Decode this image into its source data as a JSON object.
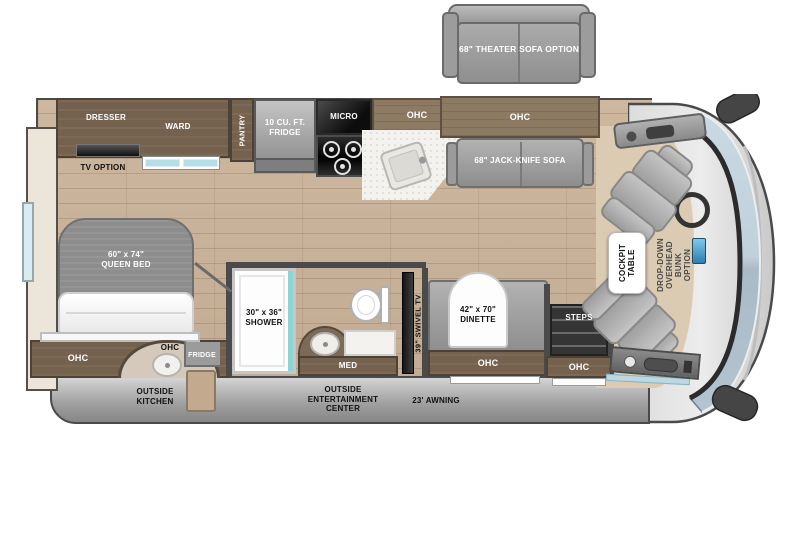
{
  "plan": {
    "type": "rv-floorplan",
    "labels": {
      "theater_sofa": "68\" THEATER SOFA OPTION",
      "dresser": "DRESSER",
      "ward": "WARD",
      "pantry": "PANTRY",
      "tv_option": "TV OPTION",
      "fridge": [
        "10 CU. FT.",
        "FRIDGE"
      ],
      "micro": "MICRO",
      "ohc": "OHC",
      "jack_knife_sofa": "68\" JACK-KNIFE SOFA",
      "queen_bed": [
        "60\" x 74\"",
        "QUEEN BED"
      ],
      "outside_fridge": "FRIDGE",
      "outside_kitchen": [
        "OUTSIDE",
        "KITCHEN"
      ],
      "shower": [
        "30\" x 36\"",
        "SHOWER"
      ],
      "med": "MED",
      "swivel_tv": "39\" SWIVEL TV",
      "dinette": [
        "42\" x 70\"",
        "DINETTE"
      ],
      "steps": "STEPS",
      "outside_entertainment": [
        "OUTSIDE",
        "ENTERTAINMENT",
        "CENTER"
      ],
      "awning": "23' AWNING",
      "cockpit_table": [
        "COCKPIT",
        "TABLE"
      ],
      "drop_down_bunk": [
        "DROP-DOWN",
        "OVERHEAD BUNK",
        "OPTION"
      ]
    },
    "colors": {
      "floor_wood": "#c9b59d",
      "cabinet_dark": "#75624e",
      "cabinet_mid": "#8d7a63",
      "furniture_gray": "#9f9f9f",
      "window_teal": "#bfe3ea",
      "windshield_blue": "#b9cdd9",
      "skirt_gray": "#a8a8a8",
      "counter_white": "#f3f2ee"
    }
  }
}
